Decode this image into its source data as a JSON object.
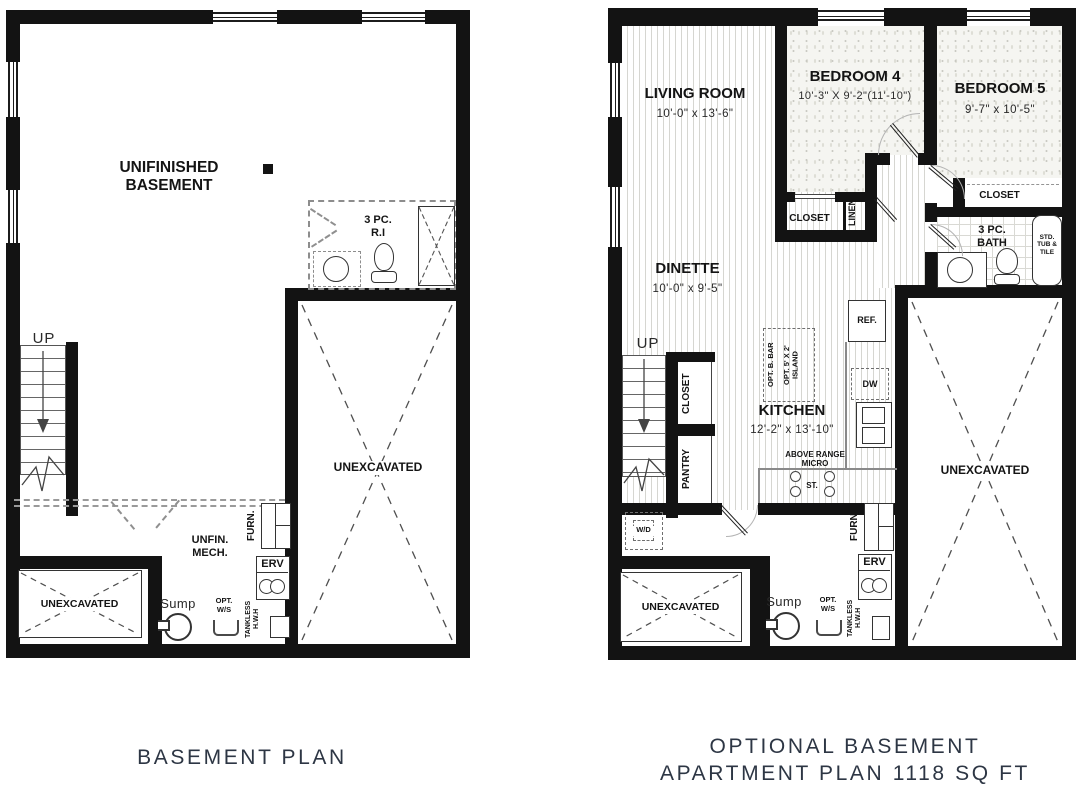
{
  "captions": {
    "left": "BASEMENT PLAN",
    "right": "OPTIONAL BASEMENT\nAPARTMENT PLAN 1118 SQ FT"
  },
  "left": {
    "labels": {
      "main_room": "UNIFINISHED BASEMENT",
      "rough_in": "3 PC.\nR.I",
      "up": "UP",
      "unexcavated_main": "UNEXCAVATED",
      "unexcavated_small": "UNEXCAVATED",
      "mech": "UNFIN.\nMECH.",
      "furnace": "FURN.",
      "erv": "ERV",
      "sump": "Sump",
      "opt_ws": "OPT.\nW/S",
      "tankless": "TANKLESS\nH.W.H"
    }
  },
  "right": {
    "rooms": {
      "living": {
        "name": "LIVING ROOM",
        "dims": "10'-0\" x 13'-6\""
      },
      "bedroom4": {
        "name": "BEDROOM 4",
        "dims": "10'-3\" X 9'-2\"(11'-10\")"
      },
      "bedroom5": {
        "name": "BEDROOM 5",
        "dims": "9'-7\" x 10'-5\""
      },
      "dinette": {
        "name": "DINETTE",
        "dims": "10'-0\" x 9'-5\""
      },
      "kitchen": {
        "name": "KITCHEN",
        "dims": "12'-2\" x 13'-10\""
      },
      "bath": {
        "name": "3 PC.\nBATH"
      }
    },
    "labels": {
      "up": "UP",
      "closet_bed4": "CLOSET",
      "linen": "LINEN",
      "closet_bed5": "CLOSET",
      "tub": "STD.\nTUB &\nTILE",
      "closet_hall": "CLOSET",
      "pantry": "PANTRY",
      "opt_bar": "OPT. B. BAR",
      "opt_island": "OPT. 5' X 2'\nISLAND",
      "ref": "REF.",
      "dw": "DW",
      "micro": "ABOVE RANGE\nMICRO",
      "stove": "ST.",
      "wd": "W/D",
      "furnace": "FURN.",
      "erv": "ERV",
      "sump": "Sump",
      "opt_ws": "OPT.\nW/S",
      "tankless": "TANKLESS\nH.W.H",
      "unexcavated_small": "UNEXCAVATED",
      "unexcavated_main": "UNEXCAVATED"
    }
  },
  "colors": {
    "wall": "#131313",
    "caption_text": "#2d3644"
  }
}
